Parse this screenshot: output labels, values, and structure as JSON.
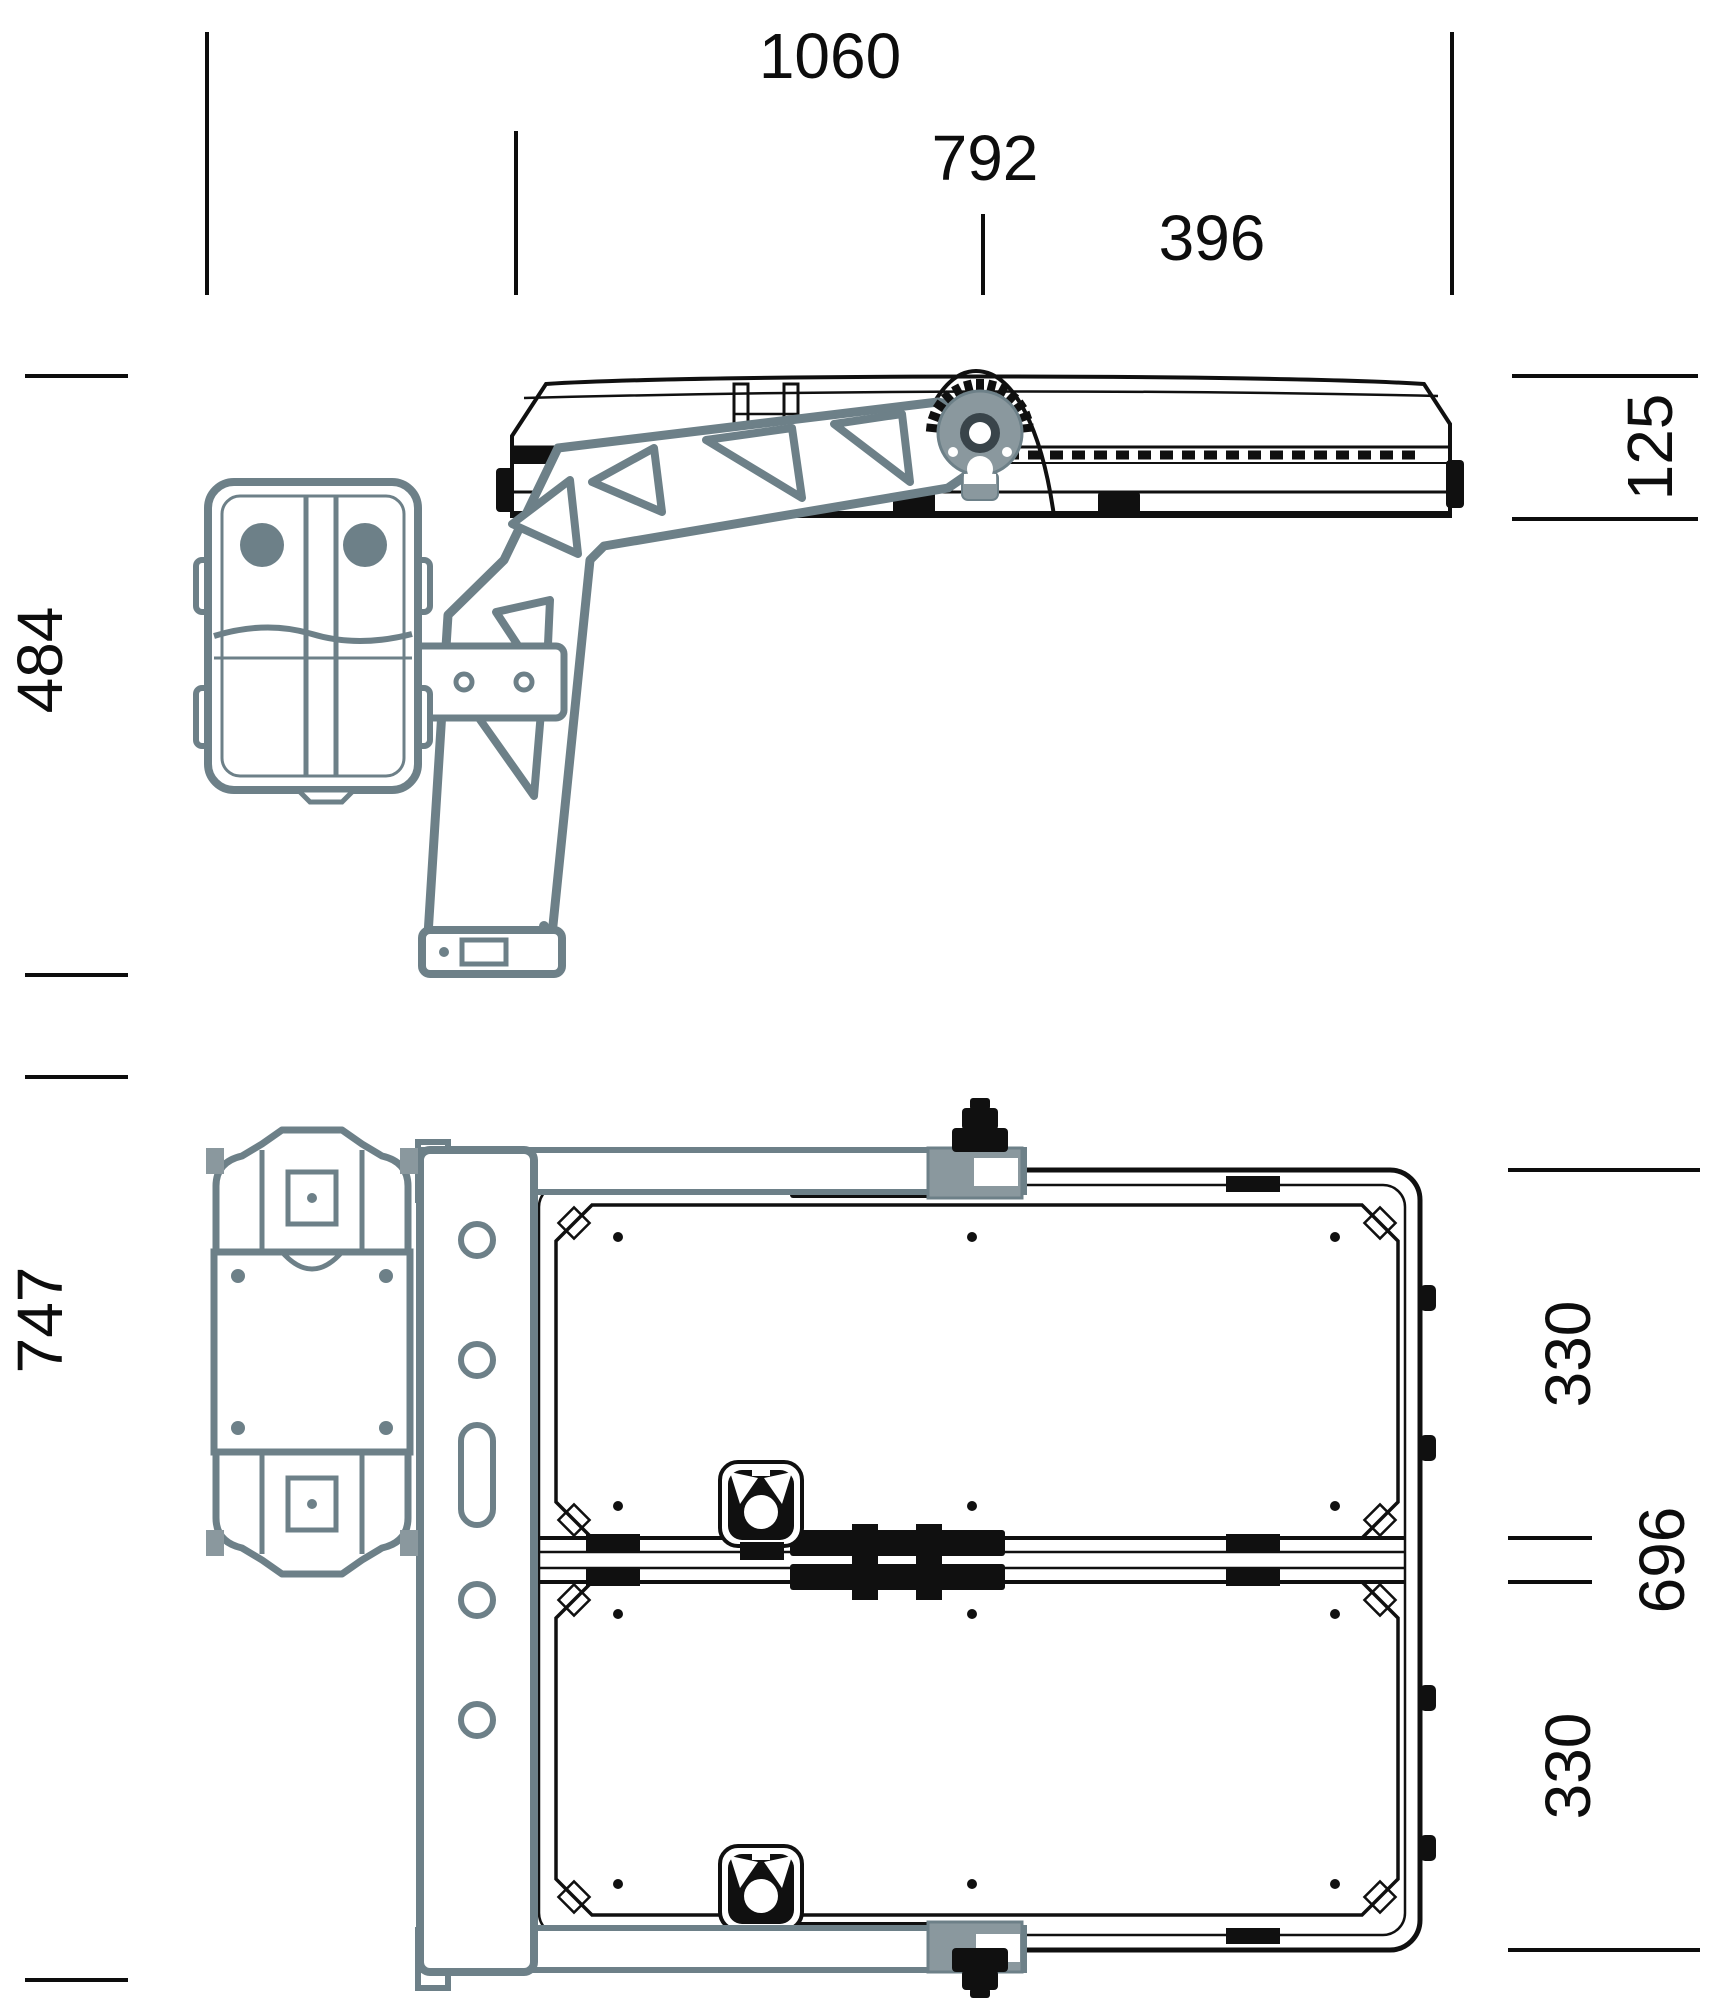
{
  "drawing": {
    "type": "technical-dimension-drawing",
    "views": {
      "side_view": "luminaire side elevation with tilt gear and pole bracket",
      "plan_view": "luminaire rear plan with mounting plate and drive unit"
    },
    "colors": {
      "line_black": "#101010",
      "bracket_gray_stroke": "#6d8088",
      "bracket_gray_fill": "#8a989e",
      "bracket_gray_dark": "#39444a"
    },
    "dims": {
      "overall_length": "1060",
      "housing_length": "792",
      "pivot_offset": "396",
      "housing_height": "125",
      "bracket_height": "484",
      "plan_height": "747",
      "module_width_top": "330",
      "frame_width": "696",
      "module_width_bottom": "330"
    }
  }
}
